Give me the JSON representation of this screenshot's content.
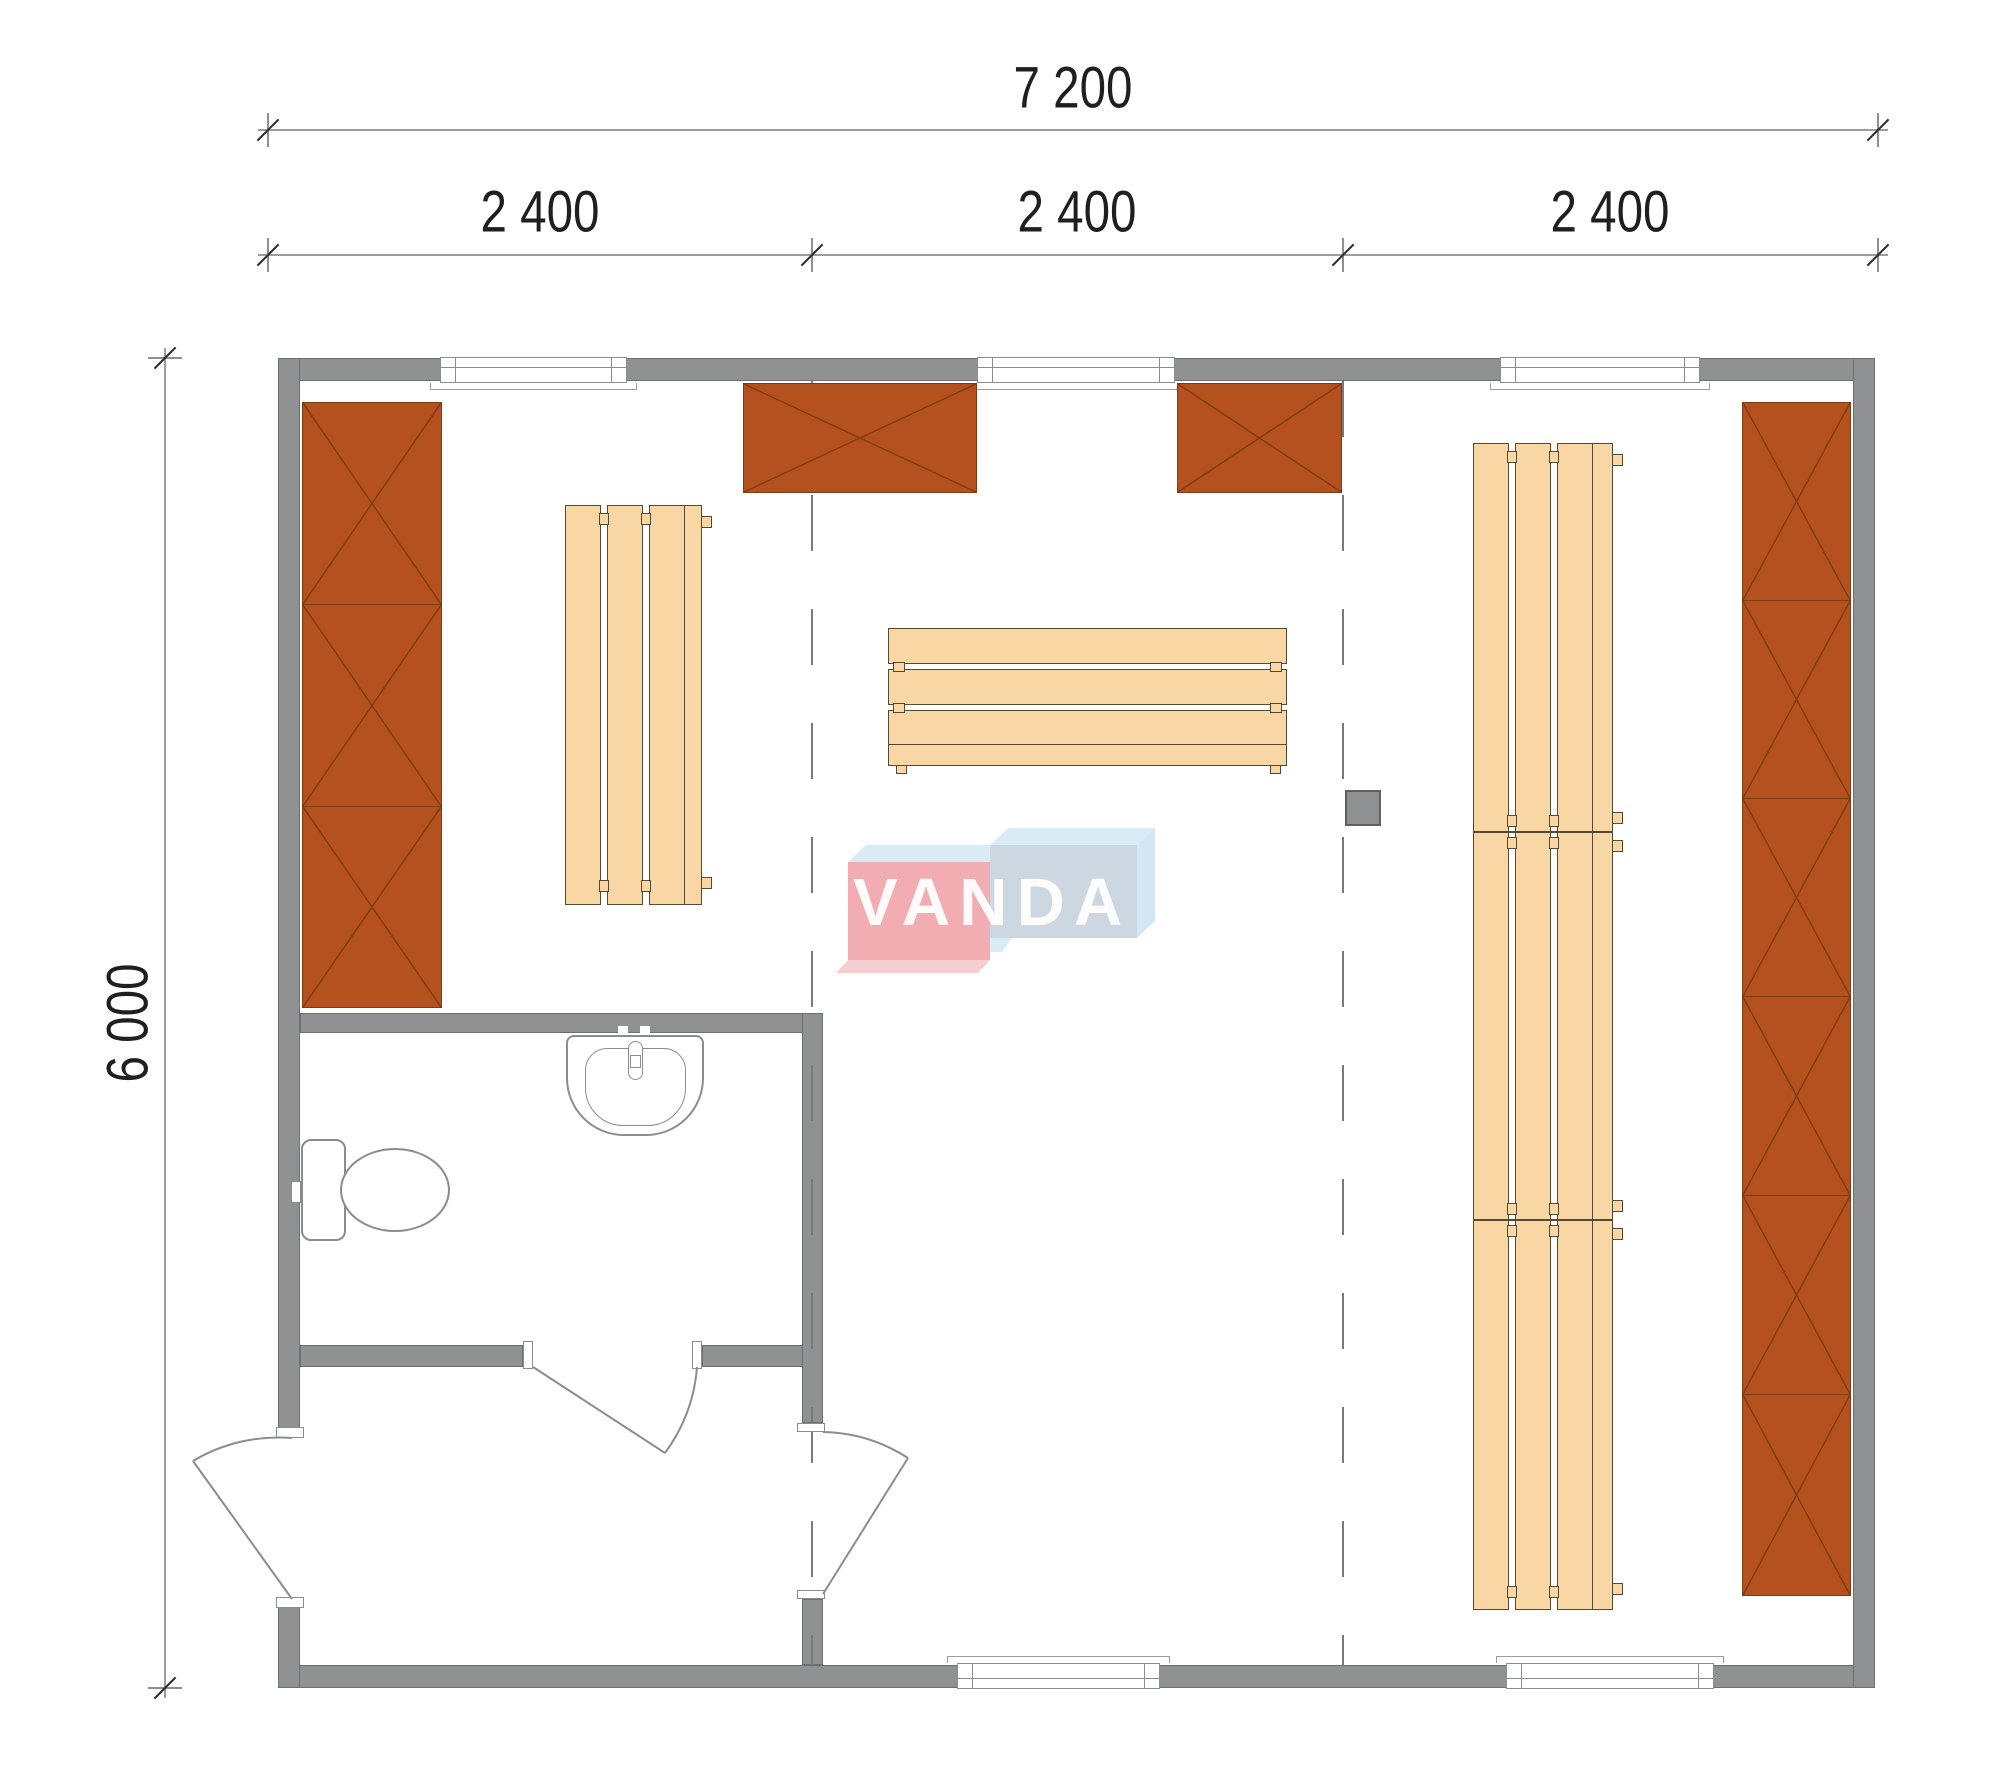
{
  "dimensions": {
    "total_width": {
      "label": "7 200"
    },
    "modules": [
      {
        "label": "2 400"
      },
      {
        "label": "2 400"
      },
      {
        "label": "2 400"
      }
    ],
    "height": {
      "label": "6 000"
    }
  },
  "watermark": {
    "text": "VANDA",
    "pink": "#f1a7ad",
    "blue_front": "#c9d4e0",
    "light_blue": "#d6eaf5"
  },
  "colors": {
    "wall": "#8f9192",
    "panel_fill": "#b4511e",
    "panel_line": "#7d3c12",
    "bench_fill": "#f9d7a4",
    "bench_line": "#564a33",
    "dashed_line": "#77797a",
    "dimension_text": "#1f1f1f"
  }
}
